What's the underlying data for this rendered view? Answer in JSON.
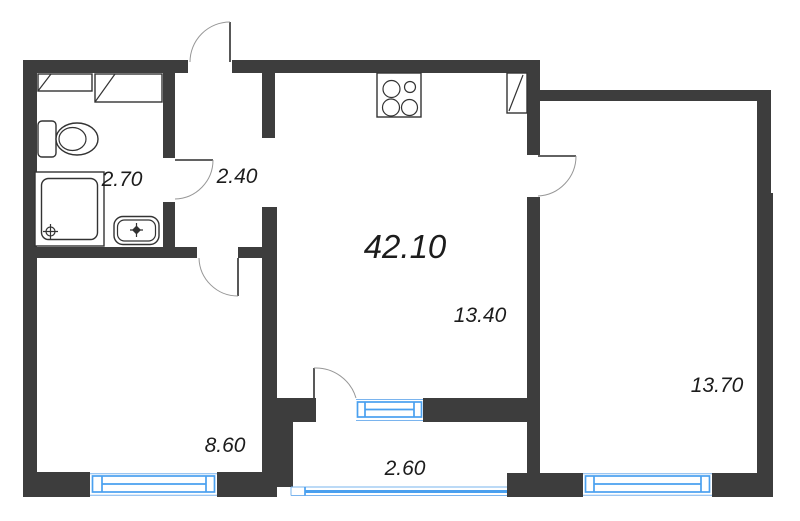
{
  "plan": {
    "total_area": "42.10",
    "areas": {
      "bathroom": "2.70",
      "hallway": "2.40",
      "kitchen_living": "13.40",
      "room_small": "8.60",
      "bedroom": "13.70",
      "balcony": "2.60"
    },
    "colors": {
      "wall": "#3d3d3d",
      "window": "#4aa0ef",
      "window_light": "#7ab4ee",
      "text": "#1c1c1c",
      "fixture": "#333333",
      "arc": "#979797",
      "bg": "#ffffff"
    }
  }
}
